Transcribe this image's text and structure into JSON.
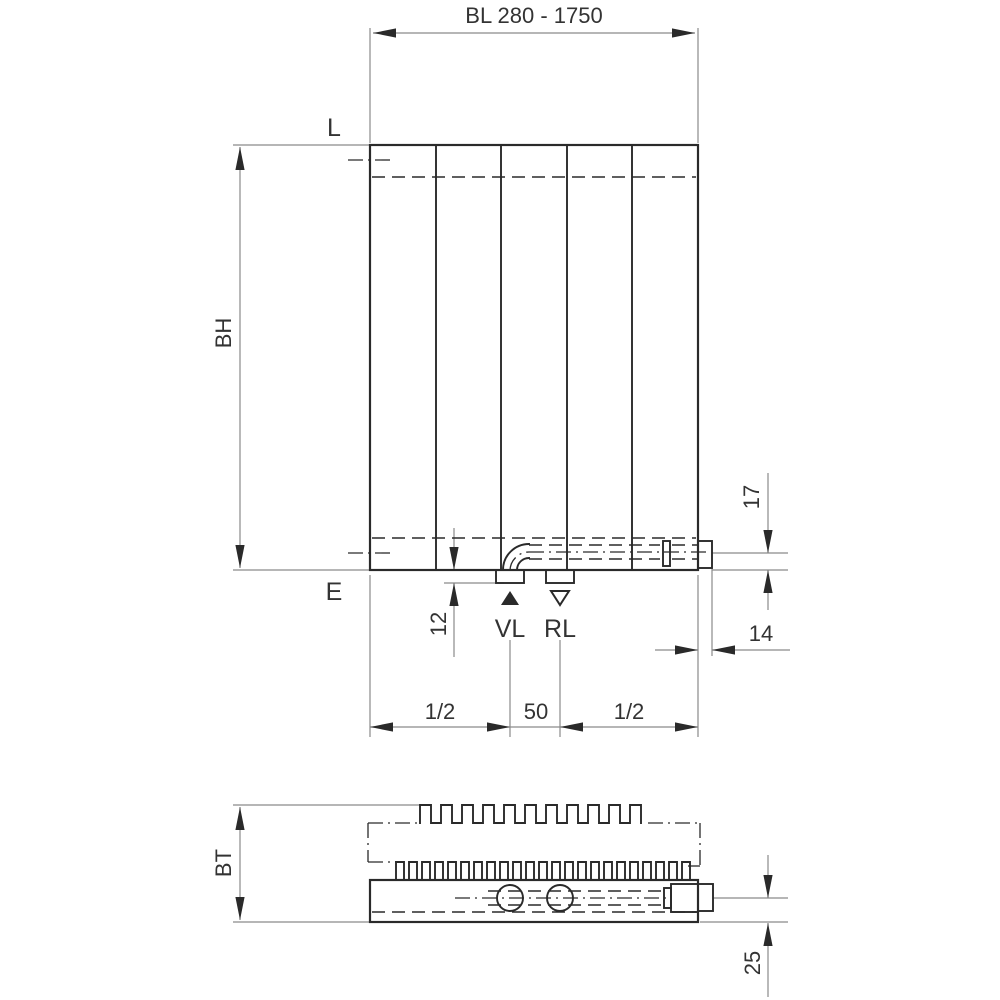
{
  "drawing": {
    "dims": {
      "bl": "BL 280 - 1750",
      "d12": "12",
      "d17": "17",
      "d14": "14",
      "d25": "25",
      "half_a": "1/2",
      "d50": "50",
      "half_b": "1/2"
    },
    "labels": {
      "l": "L",
      "e": "E",
      "bh": "BH",
      "bt": "BT",
      "vl": "VL",
      "rl": "RL"
    },
    "colors": {
      "line": "#2a2a2a",
      "thin": "#8a8a8a",
      "text": "#333333",
      "background": "#ffffff"
    }
  }
}
